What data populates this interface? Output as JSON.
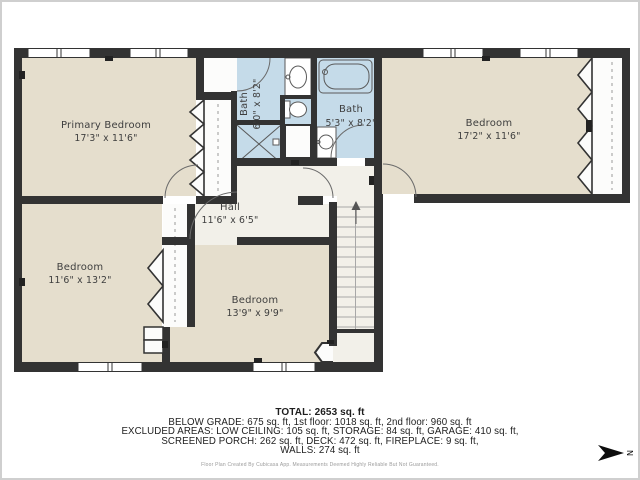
{
  "palette": {
    "wall": "#333333",
    "room_fill": "#e5decd",
    "bath_fill": "#c5dbe9",
    "hall_fill": "#f2f0e9",
    "closet_fill": "#fcfcfb"
  },
  "rooms": {
    "primary_bedroom": {
      "name": "Primary Bedroom",
      "dims": "17'3\" x 11'6\""
    },
    "bedroom_right": {
      "name": "Bedroom",
      "dims": "17'2\" x 11'6\""
    },
    "bedroom_left": {
      "name": "Bedroom",
      "dims": "11'6\" x 13'2\""
    },
    "bedroom_bottom": {
      "name": "Bedroom",
      "dims": "13'9\" x 9'9\""
    },
    "hall": {
      "name": "Hall",
      "dims": "11'6\" x 6'5\""
    },
    "bath_left": {
      "name": "Bath",
      "dims": "6'0\" x 8'2\""
    },
    "bath_right": {
      "name": "Bath",
      "dims": "5'3\" x 8'2\""
    }
  },
  "footer": {
    "total": "TOTAL: 2653 sq. ft",
    "line1": "BELOW GRADE: 675 sq. ft, 1st floor: 1018 sq. ft, 2nd floor: 960 sq. ft",
    "line2": "EXCLUDED AREAS: LOW CEILING: 105 sq. ft, STORAGE: 84 sq. ft, GARAGE: 410 sq. ft,",
    "line3": "SCREENED PORCH: 262 sq. ft, DECK: 472 sq. ft, FIREPLACE: 9 sq. ft,",
    "line4": "WALLS: 274 sq. ft",
    "disclaimer": "Floor Plan Created By Cubicasa App. Measurements Deemed Highly Reliable But Not Guaranteed."
  },
  "compass": {
    "label": "N"
  }
}
